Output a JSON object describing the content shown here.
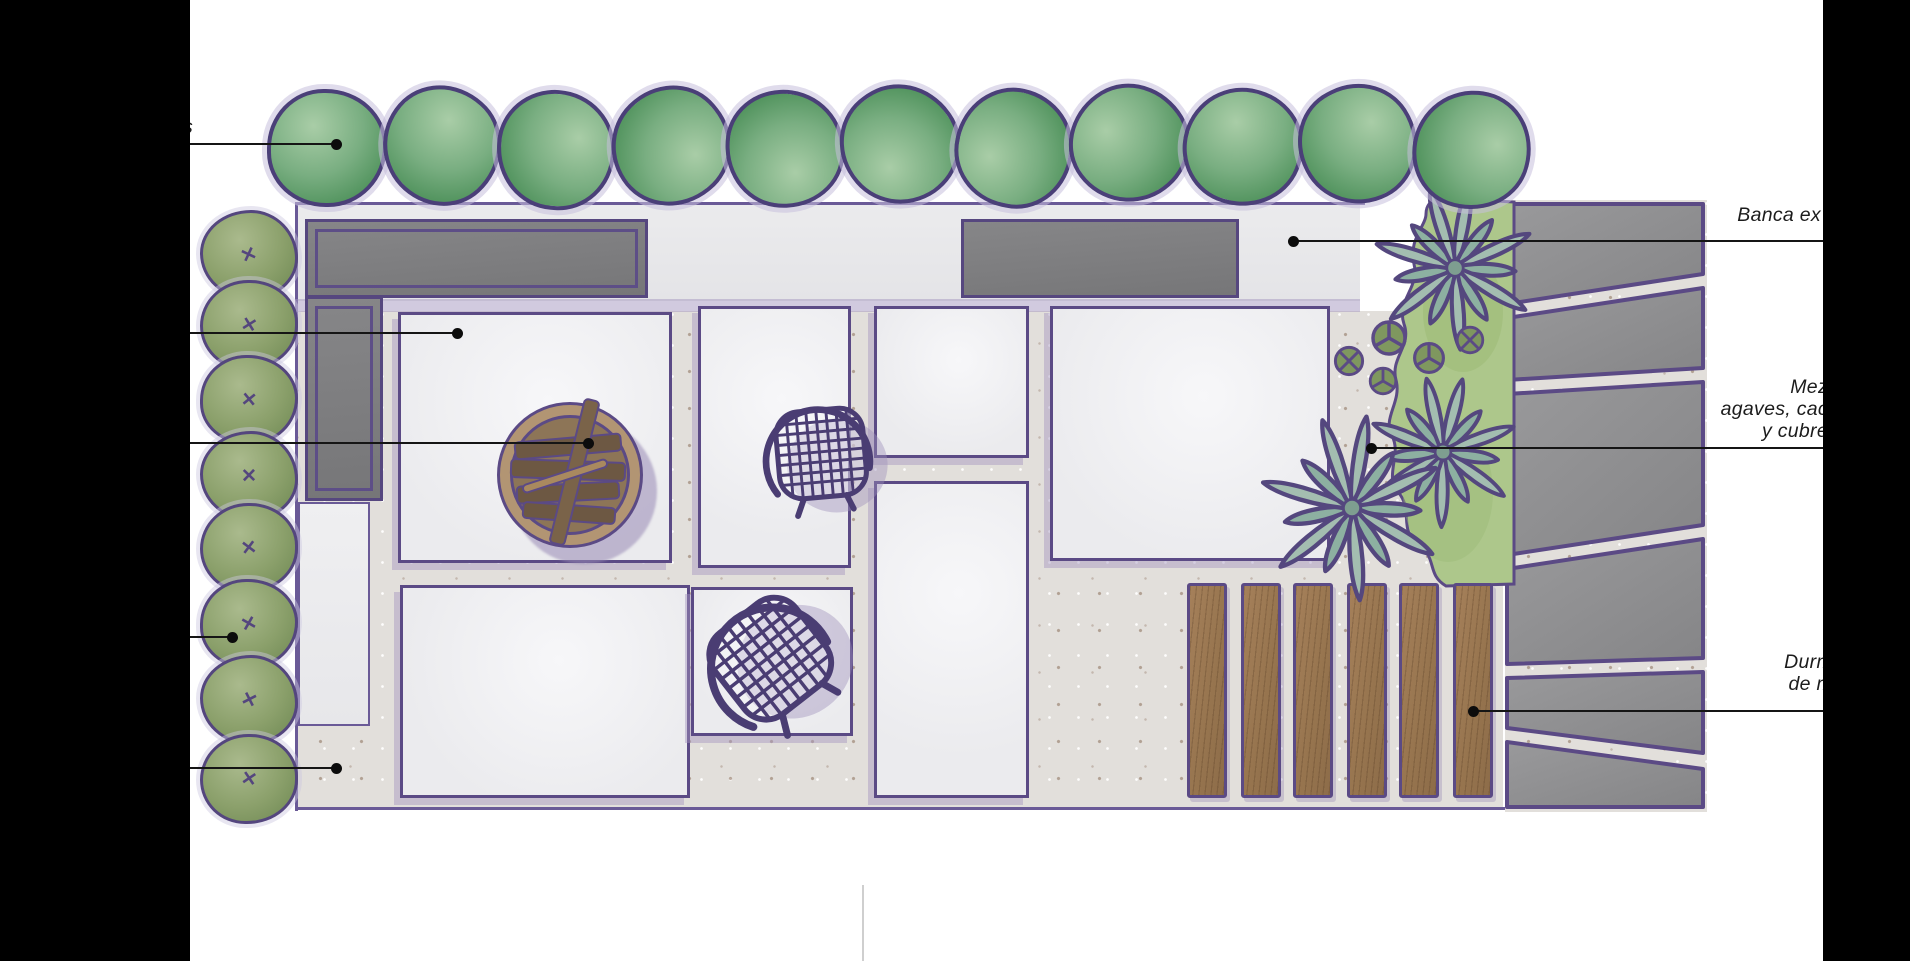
{
  "annotations": {
    "left_labels": [
      {
        "text": "s"
      }
    ],
    "right_labels": [
      {
        "name": "banca-exterior",
        "lines": [
          "Banca ex"
        ]
      },
      {
        "name": "mezcla-agaves",
        "lines": [
          "Mez",
          "agaves, cac",
          "y  cubre"
        ]
      },
      {
        "name": "durmientes",
        "lines": [
          "Durm",
          "de m"
        ]
      }
    ],
    "leader_lines": [
      {
        "x1": 190,
        "y": 143,
        "x2": 336,
        "dot": "end"
      },
      {
        "x1": 190,
        "y": 332,
        "x2": 457,
        "dot": "end"
      },
      {
        "x1": 190,
        "y": 442,
        "x2": 588,
        "dot": "end"
      },
      {
        "x1": 190,
        "y": 636,
        "x2": 232,
        "dot": "end"
      },
      {
        "x1": 190,
        "y": 767,
        "x2": 336,
        "dot": "end"
      },
      {
        "x1": 1293,
        "y": 240,
        "x2": 1830,
        "dot": "start"
      },
      {
        "x1": 1371,
        "y": 447,
        "x2": 1830,
        "dot": "start"
      },
      {
        "x1": 1473,
        "y": 710,
        "x2": 1830,
        "dot": "start"
      }
    ]
  },
  "plan": {
    "trees": {
      "xs": [
        323,
        438,
        552,
        667,
        781,
        896,
        1010,
        1125,
        1239,
        1354,
        1468
      ],
      "ys": [
        145,
        142,
        147,
        143,
        146,
        141,
        145,
        140,
        144,
        141,
        147
      ],
      "size": 112
    },
    "hedge": {
      "x": 246,
      "ys": [
        252,
        322,
        397,
        473,
        545,
        621,
        697,
        776
      ]
    },
    "planks": {
      "xs": [
        1187,
        1241,
        1293,
        1347,
        1399,
        1453
      ],
      "y": 583
    },
    "agaves": [
      {
        "x": 1455,
        "y": 268,
        "r": 90
      },
      {
        "x": 1443,
        "y": 452,
        "r": 86
      },
      {
        "x": 1352,
        "y": 508,
        "r": 96
      }
    ],
    "cacti": [
      {
        "x": 1389,
        "y": 338,
        "r": 17,
        "style": "tri"
      },
      {
        "x": 1349,
        "y": 361,
        "r": 14,
        "style": "cross"
      },
      {
        "x": 1429,
        "y": 358,
        "r": 15,
        "style": "tri"
      },
      {
        "x": 1470,
        "y": 340,
        "r": 13,
        "style": "cross"
      },
      {
        "x": 1383,
        "y": 381,
        "r": 13,
        "style": "tri"
      }
    ]
  },
  "colors": {
    "outline": "#5b4a85",
    "tree_outline": "#4a3f78",
    "bench": "#7f7f81",
    "wood": "#9e7a52",
    "slab": "#8e8e90",
    "bed": "#adc78b",
    "agave": "#9cb8aa",
    "paver": "#f1f1f3",
    "gravel": "#e0ddd9",
    "shadow": "#a99cc0",
    "leader": "#151515"
  }
}
